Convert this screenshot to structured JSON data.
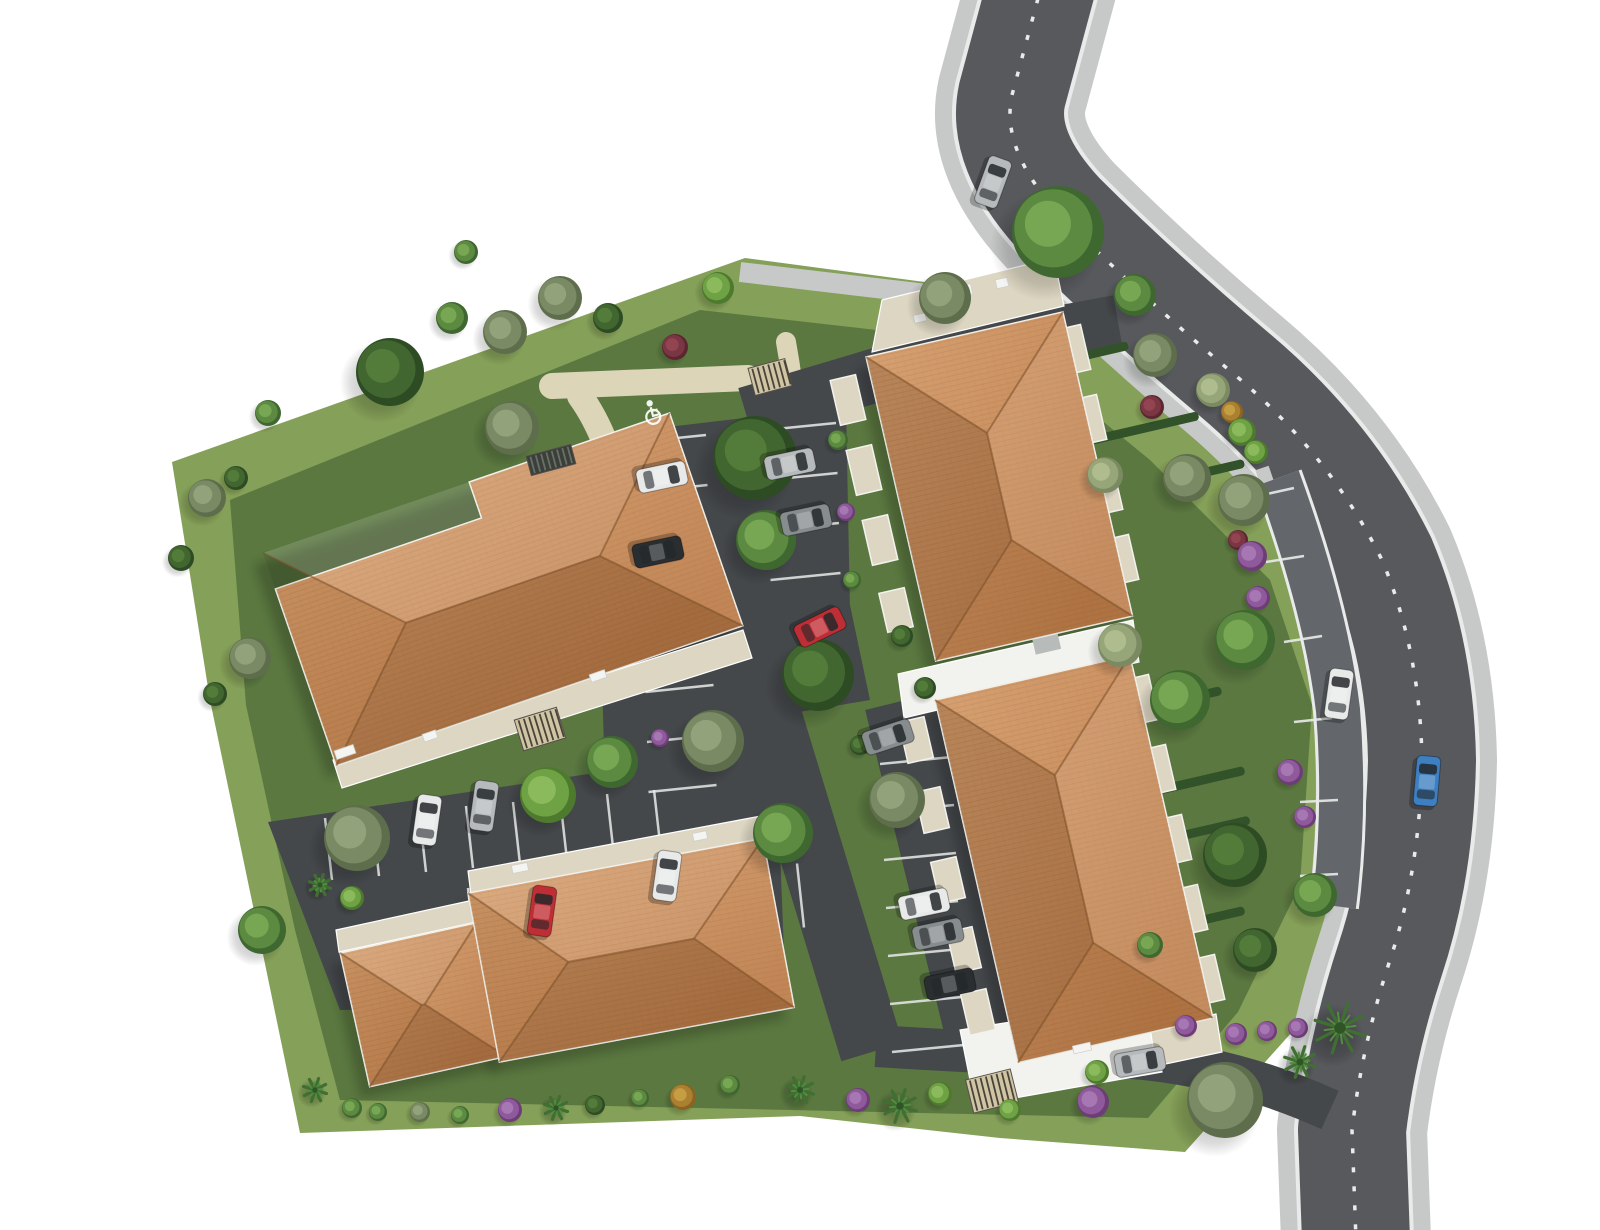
{
  "meta": {
    "kind": "aerial-3d-residential-site-plan",
    "handicap_symbol": "wheelchair-parking-marking"
  },
  "palette": {
    "bg": "#ffffff",
    "lawn": "#85a058",
    "lawn_dark": "#5b7840",
    "sidewalk": "#c7c9c8",
    "road": "#57595d",
    "lane": "#63676b",
    "lot": "#45484b",
    "white_line": "#e9ebea",
    "tan": "#ddd5b8",
    "roof_hi": "#d9a273",
    "roof_mid": "#c4814b",
    "roof_lo": "#a4683a",
    "ridge": "#7c4f28",
    "white_bldg": "#f2f2ef",
    "beige": "#ddd6c2",
    "gray_box": "#b7bbba",
    "hedge": "#32522a",
    "stripe_dark": "#4a4338",
    "stripe_tan": "#cfc5a5",
    "fence_dark": "#3a3f3a"
  },
  "tree_palettes": {
    "g1": [
      "#4e7a2e",
      "#6fa245",
      "#8fbe60"
    ],
    "g2": [
      "#3f6830",
      "#5c8a41",
      "#7cab58"
    ],
    "g3": [
      "#2e4c24",
      "#42662f",
      "#567f3c"
    ],
    "g4": [
      "#5e6e4c",
      "#7a8a64",
      "#97a67e"
    ],
    "g5": [
      "#7b8a62",
      "#97a678",
      "#b3bf92"
    ],
    "palm": [
      "#2f5526",
      "#3f7032",
      "#558c42"
    ],
    "purple": [
      "#6e3d78",
      "#8f5a9b",
      "#ab7cb8"
    ],
    "wine": [
      "#5c2630",
      "#7a3642",
      "#964652"
    ],
    "amber": [
      "#8a6420",
      "#ab8030",
      "#c9a246"
    ]
  },
  "car_colors": {
    "white": "#e8eaea",
    "silver": "#b6babc",
    "gray": "#878c8f",
    "black": "#2a2e31",
    "red": "#bf2e34",
    "blue": "#3d7fc1"
  },
  "scene": {
    "lawn_outer": "172,462 745,258 1060,300 1200,420 1330,560 1382,720 1362,900 1292,1032 1185,1152 1000,1138 800,1116 300,1133 258,930 210,700",
    "lawn_inner": "230,500 700,310 1010,345 1150,460 1270,580 1312,705 1300,885 1238,1012 1148,1118 340,1100 295,930 246,705",
    "tan_paths": [
      {
        "d": "M 552,386 L 748,378",
        "w": 26
      },
      {
        "d": "M 786,342 Q 802,430 800,525 Q 798,622 840,692",
        "w": 20
      },
      {
        "d": "M 580,396 Q 612,440 626,520",
        "w": 26
      },
      {
        "d": "M 998,1088 Q 1052,1072 1086,1060",
        "w": 12
      }
    ],
    "bands": [
      {
        "name": "sidewalk-main",
        "d": "M 1043,-20 L 1012,95 Q 1000,150 1060,215 Q 1140,295 1235,375 Q 1330,455 1382,560 Q 1420,650 1422,760 Q 1420,870 1390,960 Q 1362,1045 1352,1130 L 1356,1240",
        "w": 150,
        "c": "sidewalk"
      },
      {
        "name": "road-edge",
        "d": "M 1043,-20 L 1012,95 Q 1000,150 1060,215 Q 1140,295 1235,375 Q 1330,455 1382,560 Q 1420,650 1422,760 Q 1420,870 1390,960 Q 1362,1045 1352,1130 L 1356,1240",
        "w": 116,
        "c": "white_line"
      },
      {
        "name": "road-asphalt",
        "d": "M 1043,-20 L 1012,95 Q 1000,150 1060,215 Q 1140,295 1235,375 Q 1330,455 1382,560 Q 1420,650 1422,760 Q 1420,870 1390,960 Q 1362,1045 1352,1130 L 1356,1240",
        "w": 108,
        "c": "road"
      },
      {
        "name": "lane-sidewalk",
        "d": "M 1262,468 Q 1308,600 1320,710 Q 1328,820 1314,914",
        "w": 14,
        "c": "sidewalk"
      },
      {
        "name": "lane-edge",
        "d": "M 1278,478 Q 1326,610 1338,710 Q 1346,812 1334,906",
        "w": 50,
        "c": "white_line"
      },
      {
        "name": "lane-asphalt",
        "d": "M 1278,478 Q 1326,610 1338,710 Q 1346,812 1334,906",
        "w": 44,
        "c": "lane"
      },
      {
        "name": "top-sidewalk",
        "d": "M 740,272 L 1012,304",
        "w": 20,
        "c": "sidewalk"
      },
      {
        "name": "entry-drive",
        "d": "M 1118,322 Q 950,352 860,380 Q 800,398 746,414",
        "w": 54,
        "c": "lot"
      },
      {
        "name": "road-center-dash",
        "d": "M 1043,-20 L 1012,95 Q 1000,150 1060,215 Q 1140,295 1235,375 Q 1330,455 1382,560 Q 1420,650 1422,760 Q 1420,870 1390,960 Q 1362,1045 1352,1130 L 1356,1240",
        "w": 3.5,
        "c": "white_line",
        "dash": "5 14"
      },
      {
        "name": "aisle",
        "d": "M 740,618 L 872,1052",
        "w": 64,
        "c": "lot"
      },
      {
        "name": "stall-band",
        "d": "M 906,700 L 992,1052",
        "w": 84,
        "c": "lot"
      },
      {
        "name": "exit-drive",
        "d": "M 876,1046 Q 1000,1054 1100,1056 Q 1220,1060 1330,1110",
        "w": 42,
        "c": "lot"
      }
    ],
    "lots": [
      {
        "name": "lot-top",
        "points": "626,432 846,406 850,610 600,645"
      },
      {
        "name": "lot-corridor",
        "points": "600,612 770,590 786,1005 612,1022"
      },
      {
        "name": "lot-west",
        "points": "268,822 762,748 788,1002 340,1010"
      },
      {
        "name": "lot-joint",
        "points": "720,625 850,605 870,700 740,722"
      }
    ],
    "stall_rows": [
      {
        "x": 638,
        "y": 442,
        "dx": 68,
        "dy": -7,
        "sx": 1.5,
        "sy": 50,
        "n": 12
      },
      {
        "x": 766,
        "y": 430,
        "dx": 70,
        "dy": -7,
        "sx": 1.5,
        "sy": 50,
        "n": 4
      },
      {
        "x": 325,
        "y": 818,
        "dx": 7,
        "dy": 62,
        "sx": 47,
        "sy": -4,
        "n": 8
      },
      {
        "x": 468,
        "y": 888,
        "dx": 7,
        "dy": 64,
        "sx": 47,
        "sy": -3.5,
        "n": 8
      },
      {
        "x": 880,
        "y": 764,
        "dx": 72,
        "dy": -7,
        "sx": 2,
        "sy": 48,
        "n": 7
      }
    ],
    "lane_dividers": [
      [
        1258,
        496,
        1294,
        488
      ],
      [
        1266,
        562,
        1304,
        556
      ],
      [
        1284,
        642,
        1322,
        636
      ],
      [
        1294,
        722,
        1332,
        718
      ],
      [
        1300,
        802,
        1338,
        800
      ],
      [
        1300,
        876,
        1338,
        874
      ],
      [
        1296,
        906,
        1334,
        906
      ]
    ],
    "hedge_rot": -13,
    "hedges": [
      [
        1100,
        352,
        58
      ],
      [
        1145,
        428,
        110
      ],
      [
        1215,
        470,
        60
      ],
      [
        1180,
        700,
        85
      ],
      [
        1190,
        783,
        112
      ],
      [
        1202,
        831,
        98
      ],
      [
        1190,
        923,
        112
      ],
      [
        1162,
        989,
        95
      ],
      [
        1035,
        1012,
        55
      ]
    ],
    "roofs": [
      {
        "name": "building-a-roof",
        "x": 263,
        "y": 553,
        "rot": -19,
        "w": 430,
        "h": 225,
        "o": "h",
        "pts": "0,38 218,38 218,0 430,0 430,225 0,225"
      },
      {
        "name": "building-b-west-roof",
        "x": 340,
        "y": 953,
        "rot": -12.5,
        "w": 140,
        "h": 137,
        "o": "h"
      },
      {
        "name": "building-b-east-roof",
        "x": 468,
        "y": 893,
        "rot": -10.5,
        "w": 300,
        "h": 172,
        "o": "h"
      },
      {
        "name": "building-c-roof",
        "x": 866,
        "y": 357,
        "rot": -12.9,
        "w": 202,
        "h": 312,
        "o": "v"
      },
      {
        "name": "building-d-roof",
        "x": 935,
        "y": 700,
        "rot": -12.9,
        "w": 200,
        "h": 372,
        "o": "v"
      }
    ],
    "white_sections": [
      {
        "name": "connector-cd",
        "points": "898,674 1133,620 1139,662 904,718",
        "fill": "white_bldg"
      },
      {
        "name": "d-south-extension",
        "points": "960,1030 1150,1000 1162,1072 975,1105",
        "fill": "white_bldg"
      },
      {
        "name": "c-north-terrace",
        "points": "872,352 1064,306 1054,258 882,300",
        "fill": "beige"
      },
      {
        "name": "a-south-terrace",
        "points": "333,760 743,630 752,658 342,788",
        "fill": "beige"
      },
      {
        "name": "b-west-terrace",
        "points": "336,930 478,899 481,921 339,952",
        "fill": "beige"
      },
      {
        "name": "b-east-terrace",
        "points": "468,871 761,816 764,840 471,895",
        "fill": "beige"
      },
      {
        "name": "d-se-terrace",
        "points": "1150,1028 1216,1014 1222,1052 1156,1066",
        "fill": "beige"
      }
    ],
    "chimney": {
      "x": 1046,
      "y": 641,
      "w": 26,
      "h": 22,
      "rot": -13
    },
    "bay_rot": -13,
    "bays": [
      [
        848,
        400,
        26,
        46
      ],
      [
        864,
        470,
        26,
        46
      ],
      [
        880,
        540,
        26,
        46
      ],
      [
        896,
        610,
        26,
        40
      ],
      [
        1072,
        350,
        28,
        46
      ],
      [
        1088,
        420,
        28,
        46
      ],
      [
        1104,
        490,
        28,
        46
      ],
      [
        1120,
        560,
        28,
        46
      ],
      [
        916,
        740,
        26,
        42
      ],
      [
        932,
        810,
        26,
        42
      ],
      [
        948,
        880,
        26,
        42
      ],
      [
        964,
        950,
        26,
        42
      ],
      [
        978,
        1012,
        26,
        42
      ],
      [
        1140,
        700,
        28,
        46
      ],
      [
        1157,
        770,
        28,
        46
      ],
      [
        1173,
        840,
        28,
        46
      ],
      [
        1189,
        910,
        28,
        46
      ],
      [
        1206,
        980,
        28,
        46
      ]
    ],
    "pergolas": [
      [
        770,
        377,
        38,
        28,
        -15,
        "striped"
      ],
      [
        540,
        729,
        44,
        32,
        -17,
        "striped"
      ],
      [
        992,
        1091,
        46,
        34,
        -14,
        "striped"
      ],
      [
        551,
        460,
        46,
        20,
        -15,
        "dark"
      ]
    ],
    "decos": [
      [
        345,
        752,
        20,
        9,
        -19
      ],
      [
        430,
        736,
        14,
        8,
        -19
      ],
      [
        598,
        676,
        16,
        8,
        -19
      ],
      [
        958,
        292,
        28,
        11,
        -13
      ],
      [
        1002,
        283,
        12,
        9,
        -13
      ],
      [
        920,
        318,
        12,
        8,
        -13
      ],
      [
        1082,
        1048,
        18,
        8,
        -13
      ],
      [
        520,
        868,
        16,
        8,
        -11
      ],
      [
        700,
        836,
        14,
        8,
        -11
      ]
    ],
    "trees": [
      [
        390,
        372,
        34,
        "g3"
      ],
      [
        452,
        318,
        16,
        "g2"
      ],
      [
        505,
        332,
        22,
        "g4"
      ],
      [
        560,
        298,
        22,
        "g4"
      ],
      [
        608,
        318,
        15,
        "g3"
      ],
      [
        466,
        252,
        12,
        "g2"
      ],
      [
        268,
        413,
        13,
        "g2"
      ],
      [
        207,
        498,
        19,
        "g4"
      ],
      [
        236,
        478,
        12,
        "g3"
      ],
      [
        181,
        558,
        13,
        "g3"
      ],
      [
        250,
        658,
        21,
        "g4"
      ],
      [
        215,
        694,
        12,
        "g3"
      ],
      [
        262,
        930,
        24,
        "g2"
      ],
      [
        320,
        885,
        11,
        "palm"
      ],
      [
        512,
        428,
        27,
        "g4"
      ],
      [
        718,
        288,
        16,
        "g1"
      ],
      [
        675,
        347,
        13,
        "wine"
      ],
      [
        945,
        298,
        26,
        "g4"
      ],
      [
        1058,
        232,
        46,
        "g2"
      ],
      [
        1135,
        295,
        21,
        "g2"
      ],
      [
        755,
        458,
        42,
        "g3"
      ],
      [
        766,
        540,
        30,
        "g2"
      ],
      [
        818,
        675,
        36,
        "g3"
      ],
      [
        713,
        741,
        31,
        "g4"
      ],
      [
        783,
        833,
        30,
        "g2"
      ],
      [
        897,
        800,
        28,
        "g4"
      ],
      [
        902,
        636,
        11,
        "g3"
      ],
      [
        925,
        688,
        11,
        "g3"
      ],
      [
        357,
        838,
        33,
        "g4"
      ],
      [
        548,
        795,
        28,
        "g1"
      ],
      [
        612,
        762,
        26,
        "g2"
      ],
      [
        352,
        898,
        12,
        "g1"
      ],
      [
        660,
        738,
        9,
        "purple"
      ],
      [
        860,
        745,
        10,
        "g3"
      ],
      [
        1155,
        355,
        22,
        "g4"
      ],
      [
        1213,
        390,
        17,
        "g5"
      ],
      [
        1152,
        407,
        12,
        "wine"
      ],
      [
        1232,
        412,
        11,
        "amber"
      ],
      [
        1242,
        432,
        14,
        "g1"
      ],
      [
        1256,
        452,
        12,
        "g1"
      ],
      [
        1187,
        478,
        24,
        "g4"
      ],
      [
        1244,
        500,
        26,
        "g4"
      ],
      [
        1105,
        475,
        18,
        "g5"
      ],
      [
        1238,
        540,
        10,
        "wine"
      ],
      [
        1252,
        556,
        15,
        "purple"
      ],
      [
        1258,
        598,
        12,
        "purple"
      ],
      [
        1245,
        640,
        30,
        "g2"
      ],
      [
        1120,
        645,
        22,
        "g5"
      ],
      [
        1180,
        700,
        30,
        "g2"
      ],
      [
        1290,
        772,
        13,
        "purple"
      ],
      [
        1305,
        817,
        11,
        "purple"
      ],
      [
        1235,
        855,
        32,
        "g3"
      ],
      [
        1315,
        895,
        22,
        "g2"
      ],
      [
        1255,
        950,
        22,
        "g3"
      ],
      [
        1150,
        945,
        13,
        "g2"
      ],
      [
        838,
        440,
        10,
        "g2"
      ],
      [
        846,
        512,
        9,
        "purple"
      ],
      [
        852,
        580,
        9,
        "g2"
      ],
      [
        315,
        1090,
        12,
        "palm"
      ],
      [
        352,
        1108,
        10,
        "g2"
      ],
      [
        378,
        1112,
        9,
        "g2"
      ],
      [
        420,
        1112,
        10,
        "g4"
      ],
      [
        460,
        1115,
        9,
        "g2"
      ],
      [
        510,
        1110,
        12,
        "purple"
      ],
      [
        556,
        1108,
        12,
        "palm"
      ],
      [
        595,
        1105,
        10,
        "g3"
      ],
      [
        640,
        1098,
        9,
        "g2"
      ],
      [
        683,
        1097,
        13,
        "amber"
      ],
      [
        730,
        1085,
        10,
        "g2"
      ],
      [
        800,
        1090,
        14,
        "palm"
      ],
      [
        858,
        1100,
        12,
        "purple"
      ],
      [
        900,
        1106,
        17,
        "palm"
      ],
      [
        940,
        1094,
        12,
        "g1"
      ],
      [
        1010,
        1110,
        11,
        "g1"
      ],
      [
        1097,
        1072,
        12,
        "g1"
      ],
      [
        1093,
        1102,
        16,
        "purple"
      ],
      [
        1186,
        1026,
        11,
        "purple"
      ],
      [
        1236,
        1034,
        11,
        "purple"
      ],
      [
        1267,
        1031,
        10,
        "purple"
      ],
      [
        1298,
        1028,
        10,
        "purple"
      ],
      [
        1225,
        1100,
        38,
        "g4"
      ],
      [
        1340,
        1028,
        26,
        "palm"
      ],
      [
        1300,
        1062,
        16,
        "palm"
      ]
    ],
    "cars": [
      [
        993,
        182,
        20,
        "silver"
      ],
      [
        662,
        477,
        78,
        "white"
      ],
      [
        658,
        552,
        78,
        "black"
      ],
      [
        790,
        464,
        78,
        "silver"
      ],
      [
        806,
        520,
        78,
        "gray"
      ],
      [
        820,
        627,
        64,
        "red"
      ],
      [
        888,
        737,
        72,
        "gray"
      ],
      [
        924,
        904,
        78,
        "white"
      ],
      [
        938,
        934,
        78,
        "gray"
      ],
      [
        950,
        984,
        78,
        "black"
      ],
      [
        427,
        820,
        8,
        "white"
      ],
      [
        484,
        806,
        8,
        "silver"
      ],
      [
        542,
        911,
        8,
        "red"
      ],
      [
        667,
        876,
        8,
        "white"
      ],
      [
        1339,
        694,
        8,
        "white"
      ],
      [
        1427,
        781,
        5,
        "blue"
      ],
      [
        1140,
        1062,
        80,
        "silver"
      ]
    ],
    "handicap": {
      "x": 652,
      "y": 412,
      "rot": -15
    }
  }
}
